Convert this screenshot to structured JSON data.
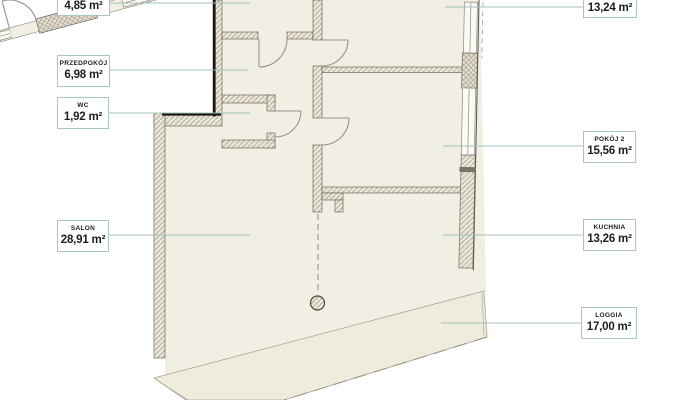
{
  "document": {
    "kind": "apartment-floor-plan",
    "language": "pl"
  },
  "palette": {
    "background": "#ffffff",
    "interior_fill": "#f1eee3",
    "loggia_fill": "#efecdd",
    "wall_fill": "#ebe7d8",
    "wall_hatch_line": "#b5ac9b",
    "wall_edge": "#6b6961",
    "black_accent_edge": "#16160f",
    "window_fill": "#fbfaf4",
    "door_stroke": "#97958a",
    "leader_line": "#a3c4bb",
    "label_border": "#a9c6bd",
    "label_text": "#1d1d1b"
  },
  "labels": [
    {
      "id": "room-top-left",
      "name": "",
      "area": "4,85 m²"
    },
    {
      "id": "przedpokoj",
      "name": "PRZEDPOKÓJ",
      "area": "6,98 m²"
    },
    {
      "id": "wc",
      "name": "WC",
      "area": "1,92 m²"
    },
    {
      "id": "salon",
      "name": "SALON",
      "area": "28,91 m²"
    },
    {
      "id": "room-top-right",
      "name": "",
      "area": "13,24 m²"
    },
    {
      "id": "pokoj-2",
      "name": "POKÓJ 2",
      "area": "15,56 m²"
    },
    {
      "id": "kuchnia",
      "name": "KUCHNIA",
      "area": "13,26 m²"
    },
    {
      "id": "loggia",
      "name": "LOGGIA",
      "area": "17,00 m²"
    }
  ]
}
